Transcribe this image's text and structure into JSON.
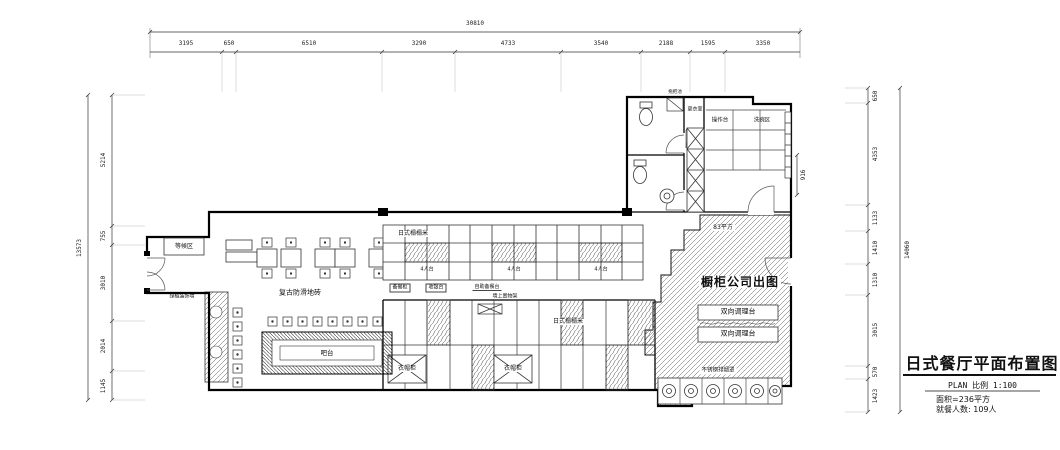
{
  "title_block": {
    "title": "日式餐厅平面布置图",
    "scale": "PLAN 比例  1:100",
    "area": "面积=236平方",
    "diners": "就餐人数: 109人"
  },
  "dimensions": {
    "top": {
      "total": "30810",
      "segments": [
        "3195",
        "650",
        "6510",
        "3290",
        "4733",
        "3540",
        "2188",
        "1595",
        "3350"
      ]
    },
    "left": {
      "total": "13573",
      "segments": [
        "5214",
        "755",
        "3010",
        "2014",
        "1145"
      ]
    },
    "right": {
      "total": "14060",
      "segments": [
        "650",
        "4353",
        "1133",
        "1410",
        "1310",
        "3015",
        "570",
        "1423"
      ],
      "door": "916"
    }
  },
  "rooms": {
    "waiting": "等候区",
    "changing": "更衣室",
    "mop_sink": "拖把池",
    "worktable": "操作台",
    "dishwash": "洗碗区"
  },
  "labels": {
    "floor": "复古防滑地砖",
    "tatami": "日式榻榻米",
    "seat4": "4人台",
    "bar": "吧台",
    "wardrobe": "衣帽柜",
    "green_wall": "绿植装饰墙",
    "prep_cabinet": "备餐柜",
    "cashier": "收银台",
    "service_counter": "自助备餐台",
    "wall_shelf": "墙上置物架",
    "kitchen_note": "橱柜公司出图",
    "prep_counter": "双向调理台",
    "area": "83平方",
    "hood": "不锈钢排烟罩"
  }
}
